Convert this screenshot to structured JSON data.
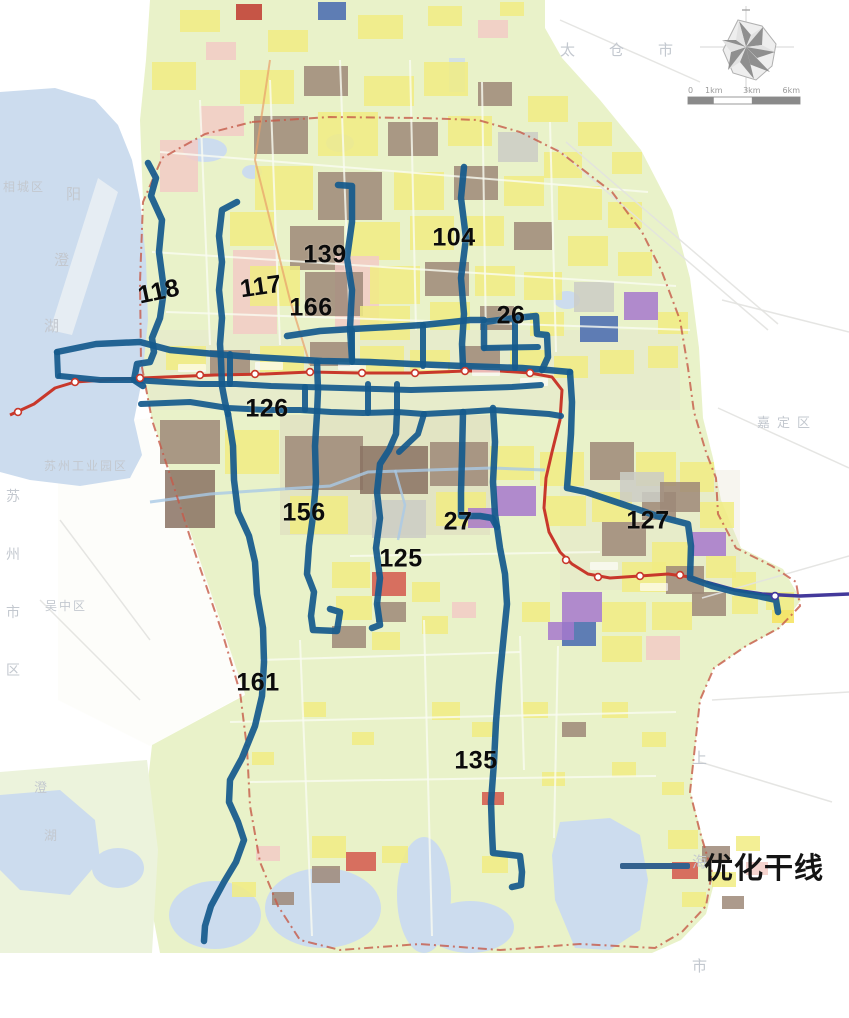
{
  "map_data": {
    "legend": {
      "label": "优化干线",
      "line_color": "#33618e"
    },
    "scale_bar": {
      "x": 688,
      "y": 97,
      "width": 112,
      "labels": [
        "0",
        "1km",
        "3km",
        "6km"
      ]
    },
    "colors": {
      "route": "#165a8d",
      "rail": "#c8382b",
      "metro": "#43399b",
      "boundary": "#c65a48",
      "water": "#ccdcee",
      "land": "#e9f2c9"
    },
    "place_labels": [
      {
        "text": "太仓市",
        "x": 560,
        "y": 42,
        "size": 15,
        "ls": 34
      },
      {
        "text": "嘉定区",
        "x": 757,
        "y": 417,
        "size": 13,
        "ls": 7
      },
      {
        "text": "苏州工业园区",
        "x": 44,
        "y": 460,
        "size": 12,
        "ls": 2
      },
      {
        "text": "吴中区",
        "x": 45,
        "y": 600,
        "size": 12,
        "ls": 2
      },
      {
        "text": "相城区",
        "x": 3,
        "y": 181,
        "size": 12,
        "ls": 2
      },
      {
        "text": "苏州市区",
        "x": 6,
        "y": 468,
        "size": 14,
        "vertical": true,
        "gap": 58
      },
      {
        "text": "上海市",
        "x": 692,
        "y": 706,
        "size": 15,
        "vertical": true,
        "gap": 104
      },
      {
        "text": "阳",
        "x": 66,
        "y": 186,
        "size": 15
      },
      {
        "text": "澄",
        "x": 54,
        "y": 252,
        "size": 15
      },
      {
        "text": "湖",
        "x": 44,
        "y": 318,
        "size": 15
      },
      {
        "text": "澄",
        "x": 34,
        "y": 782,
        "size": 13
      },
      {
        "text": "湖",
        "x": 44,
        "y": 830,
        "size": 13
      }
    ],
    "routes": [
      {
        "number": "118",
        "label": [
          159,
          292
        ],
        "rot": -12,
        "points": [
          148,
          163,
          156,
          178,
          151,
          196,
          162,
          220,
          159,
          252,
          164,
          290,
          160,
          318,
          152,
          338,
          154,
          352,
          150,
          362,
          137,
          364,
          134,
          380,
          143,
          386
        ]
      },
      {
        "number": "117",
        "label": [
          261,
          287
        ],
        "rot": -8,
        "points": [
          237,
          202,
          222,
          210,
          219,
          236,
          222,
          262,
          219,
          290,
          222,
          318,
          220,
          344,
          221,
          360,
          222,
          386,
          225,
          402,
          228,
          414
        ]
      },
      {
        "number": "161",
        "label": [
          258,
          683
        ],
        "rot": 0,
        "points": [
          228,
          414,
          233,
          446,
          234,
          480,
          238,
          512,
          249,
          536,
          255,
          562,
          257,
          594,
          263,
          628,
          264,
          662,
          262,
          696,
          255,
          726,
          242,
          758,
          230,
          780,
          229,
          802,
          238,
          822,
          244,
          840,
          236,
          862,
          224,
          882,
          211,
          906,
          205,
          926,
          204,
          941
        ]
      },
      {
        "number": "139",
        "label": [
          325,
          255
        ],
        "rot": 0,
        "points": [
          338,
          185,
          352,
          186,
          352,
          222,
          347,
          258,
          352,
          290,
          350,
          328,
          352,
          360
        ]
      },
      {
        "number": "166",
        "label": [
          311,
          308
        ],
        "rot": 0,
        "points": [
          287,
          336,
          320,
          331,
          352,
          329,
          390,
          327,
          423,
          325,
          452,
          322,
          470,
          320,
          484,
          320
        ]
      },
      {
        "number": "104",
        "label": [
          454,
          238
        ],
        "rot": 0,
        "points": [
          464,
          167,
          461,
          198,
          466,
          238,
          461,
          278,
          464,
          314,
          462,
          344,
          463,
          367
        ]
      },
      {
        "number": "26",
        "label": [
          511,
          316
        ],
        "rot": 0,
        "points": [
          484,
          348,
          484,
          322,
          515,
          318,
          536,
          316,
          537,
          334,
          547,
          335,
          548,
          357,
          542,
          370
        ]
      },
      {
        "number": "126",
        "label": [
          267,
          409
        ],
        "rot": 0,
        "points": [
          57,
          352,
          96,
          344,
          140,
          342,
          170,
          350,
          215,
          354,
          252,
          357,
          288,
          359,
          322,
          361,
          370,
          362,
          412,
          364,
          463,
          366,
          492,
          367,
          522,
          368,
          548,
          370,
          570,
          372
        ]
      },
      {
        "number": "156",
        "label": [
          304,
          513
        ],
        "rot": 0,
        "points": [
          317,
          362,
          318,
          390,
          317,
          414,
          315,
          446,
          316,
          482,
          313,
          516,
          309,
          546,
          307,
          574,
          314,
          592,
          311,
          616,
          313,
          630,
          337,
          631,
          340,
          612,
          330,
          609
        ]
      },
      {
        "number": "125",
        "label": [
          401,
          559
        ],
        "rot": 0,
        "points": [
          397,
          412,
          396,
          434,
          389,
          450,
          380,
          464,
          377,
          492,
          380,
          518,
          376,
          548,
          380,
          578,
          377,
          604,
          380,
          625,
          372,
          628
        ]
      },
      {
        "number": "27",
        "label": [
          458,
          522
        ],
        "rot": 0,
        "points": [
          463,
          412,
          462,
          456,
          461,
          492,
          461,
          516,
          480,
          516,
          492,
          518,
          497,
          527
        ]
      },
      {
        "number": "135",
        "label": [
          476,
          761
        ],
        "rot": 0,
        "points": [
          493,
          408,
          495,
          442,
          493,
          482,
          495,
          514,
          497,
          527,
          500,
          548,
          505,
          574,
          507,
          604,
          503,
          644,
          499,
          684,
          496,
          722,
          494,
          762,
          491,
          802,
          492,
          832,
          493,
          853,
          520,
          856,
          522,
          872,
          521,
          885,
          512,
          887
        ]
      },
      {
        "number": "127",
        "label": [
          648,
          521
        ],
        "rot": 0,
        "points": [
          570,
          372,
          572,
          402,
          571,
          434,
          569,
          462,
          567,
          488,
          586,
          492,
          622,
          504,
          657,
          516,
          688,
          524,
          691,
          546,
          690,
          578,
          712,
          586,
          735,
          592,
          758,
          596,
          776,
          600,
          778,
          612
        ]
      }
    ],
    "extra_lines": [
      [
        60,
        376,
        100,
        380,
        133,
        380,
        166,
        382,
        200,
        384,
        236,
        384,
        271,
        386,
        306,
        387,
        341,
        388,
        376,
        389,
        411,
        390,
        446,
        389,
        481,
        388,
        512,
        387,
        541,
        385
      ],
      [
        141,
        404,
        190,
        402,
        228,
        408,
        266,
        410,
        300,
        410,
        331,
        412,
        363,
        413,
        397,
        412,
        424,
        414,
        463,
        412,
        493,
        410,
        521,
        412,
        549,
        414,
        561,
        416
      ],
      [
        57,
        352,
        58,
        376
      ],
      [
        352,
        330,
        352,
        362
      ],
      [
        423,
        325,
        423,
        366
      ],
      [
        515,
        318,
        515,
        368
      ],
      [
        368,
        384,
        368,
        413
      ],
      [
        397,
        384,
        397,
        413
      ],
      [
        230,
        354,
        230,
        384
      ],
      [
        484,
        348,
        538,
        347
      ],
      [
        424,
        414,
        418,
        434,
        399,
        452
      ],
      [
        305,
        387,
        305,
        410
      ]
    ],
    "rail": {
      "points": [
        10,
        415,
        34,
        404,
        55,
        388,
        75,
        382,
        120,
        379,
        165,
        377,
        215,
        375,
        265,
        374,
        310,
        372,
        360,
        373,
        415,
        373,
        465,
        371,
        500,
        371,
        530,
        373,
        552,
        377,
        562,
        390,
        560,
        420,
        552,
        452,
        546,
        478,
        544,
        508,
        549,
        532,
        560,
        552,
        572,
        564,
        588,
        574,
        610,
        578,
        640,
        576,
        668,
        574,
        690,
        577,
        706,
        582
      ],
      "stations": [
        18,
        412,
        75,
        382,
        140,
        378,
        200,
        375,
        255,
        374,
        310,
        372,
        362,
        373,
        415,
        373,
        465,
        371,
        530,
        373,
        566,
        560,
        598,
        577,
        640,
        576,
        680,
        575
      ]
    },
    "metro": {
      "points": [
        706,
        582,
        735,
        590,
        762,
        594,
        800,
        596,
        849,
        594
      ],
      "stations": [
        775,
        596
      ]
    },
    "boundary": [
      252,
      122,
      330,
      117,
      420,
      118,
      478,
      120,
      520,
      132,
      560,
      152,
      612,
      192,
      642,
      232,
      662,
      272,
      680,
      320,
      688,
      368,
      694,
      412,
      706,
      452,
      716,
      478,
      718,
      514,
      736,
      548,
      772,
      566,
      796,
      582,
      800,
      606,
      779,
      628,
      746,
      646,
      714,
      668,
      700,
      700,
      695,
      746,
      690,
      792,
      700,
      832,
      712,
      872,
      706,
      906,
      682,
      932,
      655,
      948,
      580,
      944,
      500,
      950,
      420,
      944,
      340,
      950,
      300,
      940,
      278,
      906,
      260,
      862,
      250,
      806,
      247,
      748,
      240,
      692,
      222,
      632,
      198,
      562,
      173,
      484,
      152,
      420,
      141,
      362,
      140,
      282,
      143,
      202,
      162,
      158,
      205,
      134,
      252,
      122
    ]
  }
}
